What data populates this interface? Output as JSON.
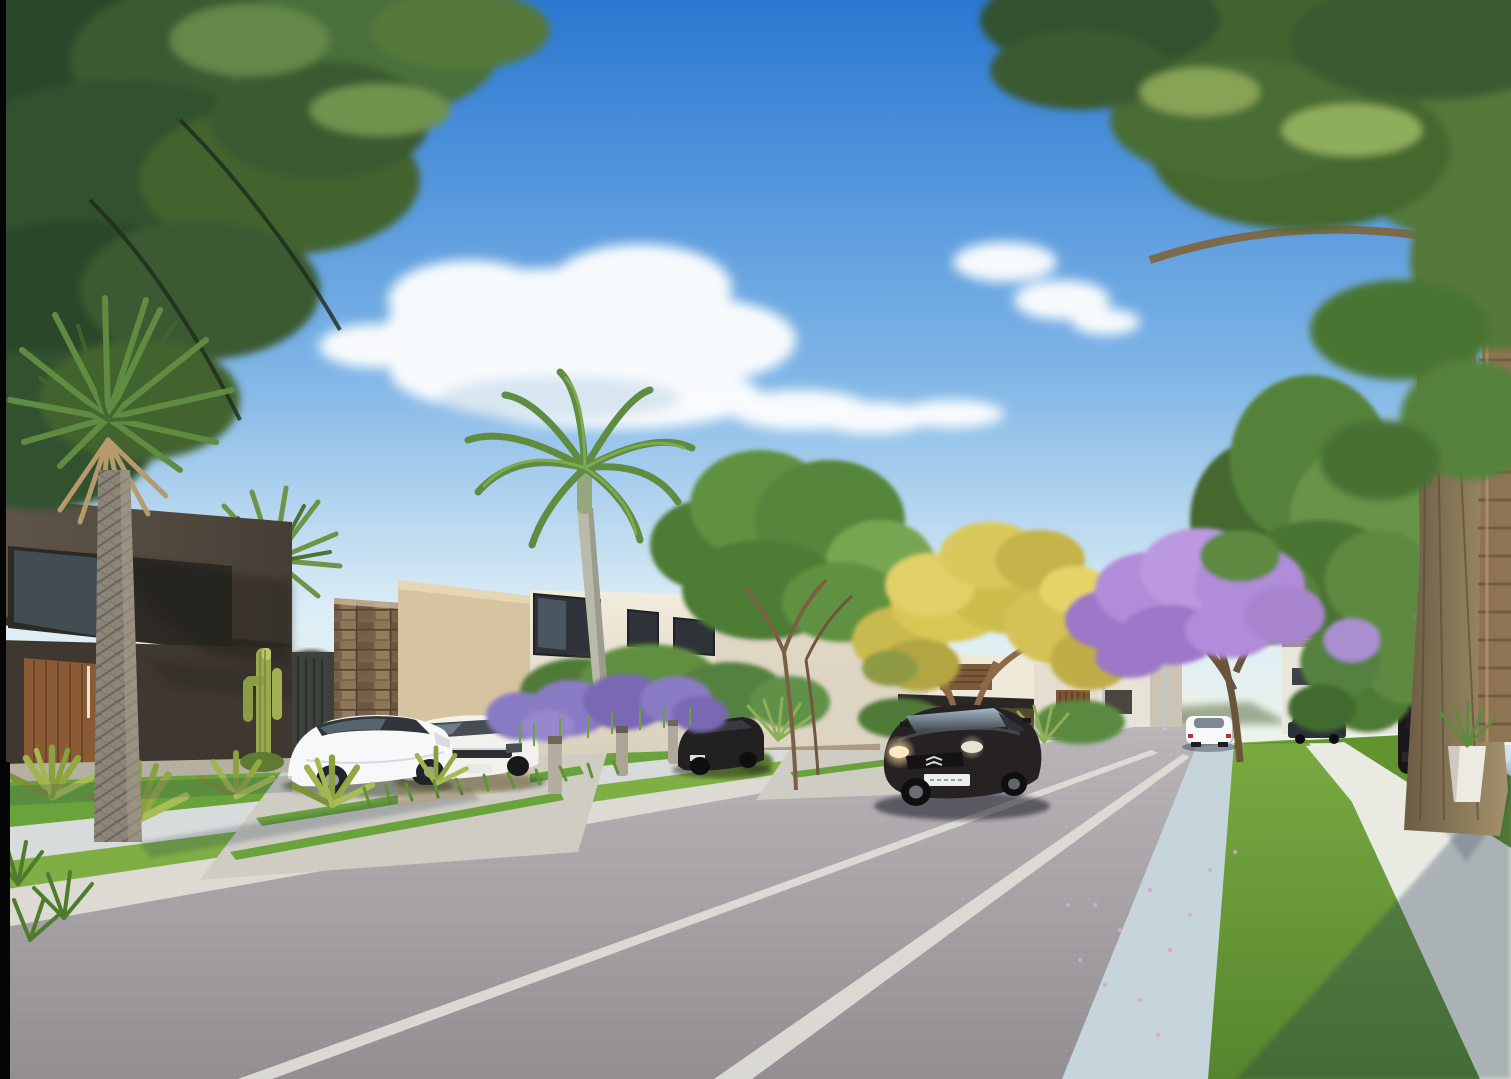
{
  "meta": {
    "kind": "photorealistic 3D architectural rendering",
    "subject": "Sunny street inside a modern residential condominium, one-point perspective down an asphalt road",
    "width": 1511,
    "height": 1079
  },
  "scene": {
    "sky": {
      "description": "deep azure sky fading to pale warm horizon",
      "clouds": "scattered soft white cumulus, mid-left"
    },
    "street": {
      "surface": "gray asphalt roadway",
      "markings": "double white lane lines converging to vanishing point at right-center",
      "curbs": "white concrete curb left, pale blue-white curb right",
      "sidewalks": "concrete sidewalks with mowed grass verges on both sides",
      "details": "driveway crossings with grass joints, fallen purple petals on right lane, long tree shadow over right corner"
    },
    "buildings": [
      {
        "name": "dark-modern-house",
        "description": "two-story dark taupe cubic house, cantilevered upper box, ribbon window, timber slat entry door with white pull"
      },
      {
        "name": "stone-accent-wall",
        "description": "brown stacked-stone feature wall panel beside beige perimeter wall"
      },
      {
        "name": "white-modern-house",
        "description": "white flat-roof two-story house, beige sunlit side wall, black framed windows"
      },
      {
        "name": "carport-house",
        "description": "white house with dark flat carport slab, patio umbrella and timber gate"
      },
      {
        "name": "distant-houses",
        "description": "white minimalist houses receding down the right side of the street"
      }
    ],
    "vehicles": [
      {
        "name": "citroen-sedan",
        "description": "dark charcoal Citroen DS5 driving toward viewer, headlights lit, white plate"
      },
      {
        "name": "white-coupe-parked",
        "description": "white coupe parked on left driveway"
      },
      {
        "name": "pearl-sedan-parked",
        "description": "pearl white sedan parked beside coupe"
      },
      {
        "name": "black-suv-parked",
        "description": "black SUV parked by beige wall"
      },
      {
        "name": "distant-white-car",
        "description": "white sedan driving away near vanishing point"
      },
      {
        "name": "dark-pickup",
        "description": "dark pickup truck parked far right"
      },
      {
        "name": "right-suv",
        "description": "black SUV rear view in right-side driveway"
      }
    ],
    "vegetation": [
      {
        "name": "overhanging-trees",
        "description": "feathery green canopies framing top-left and top-right corners"
      },
      {
        "name": "fan-palm",
        "description": "tall fan palm with textured trunk in front of dark house"
      },
      {
        "name": "royal-palm",
        "description": "slender royal palm above white house"
      },
      {
        "name": "ipe-yellow-tree",
        "description": "yellow flowering ipe tree at center right"
      },
      {
        "name": "jacaranda-tree",
        "description": "purple flowering jacaranda on right verge"
      },
      {
        "name": "lavender-bed",
        "description": "purple lavender spikes along front garden with bollard lights"
      },
      {
        "name": "agave-plants",
        "description": "spiky agave rosettes on left lawn"
      },
      {
        "name": "saguaro-cactus",
        "description": "green columnar cactus beside dark house"
      },
      {
        "name": "leaning-trunk",
        "description": "thick leaning tree trunk and ringed palm trunk at right edge"
      }
    ]
  },
  "colors": {
    "sky_top": "#2a78d2",
    "sky_mid": "#7fb5e6",
    "sky_horizon": "#dcedf6",
    "cloud": "#ffffff",
    "hills": "#8a9878",
    "asphalt_near": "#928e92",
    "asphalt_far": "#bab6b9",
    "lane_line": "#e0ded8",
    "curb_left": "#dcdad2",
    "curb_right": "#c6d4dc",
    "sidewalk_left": "#d7dbdb",
    "sidewalk_right": "#e9ebe3",
    "lawn": "#6aa23c",
    "grass_light": "#7fae44",
    "grass_dark": "#55862e",
    "house_dark_light": "#60554a",
    "house_dark_shade": "#463e35",
    "wood_door": "#8a5a34",
    "stone_wall": "#7a644c",
    "beige_wall": "#d3c09e",
    "white_house": "#f2ecdd",
    "carport_shade": "#553f2c",
    "foliage_dark": "#2c462a",
    "foliage_mid": "#44682f",
    "foliage_light": "#67944a",
    "palm_frond": "#5f8c41",
    "lavender": "#8a7bc4",
    "jacaranda": "#b18cd8",
    "ipe_yellow": "#d8c755",
    "trunk_light": "#a5916b",
    "trunk_dark": "#6a5c44",
    "palm_trunk": "#8f7454",
    "car_white": "#f6f8f9",
    "car_pearl": "#f2f1ec",
    "car_black": "#262223",
    "suv_black": "#222021",
    "suv_right": "#191619",
    "pickup": "#2b313a",
    "headlight_glow": "#ffe9c0",
    "shadow": "#1c3050"
  }
}
